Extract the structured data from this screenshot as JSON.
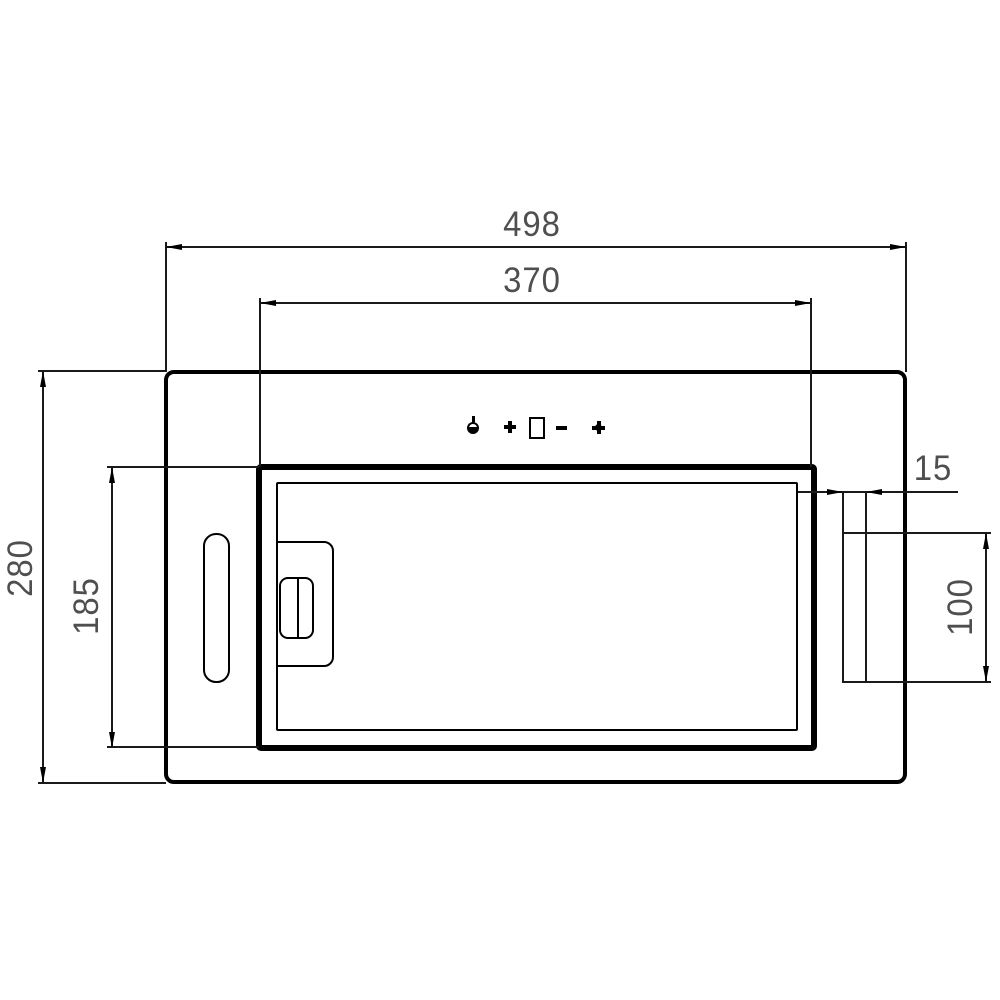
{
  "drawing": {
    "kind": "built-in cooker hood dimension drawing",
    "units": "mm",
    "dimensions": {
      "overall_width": "498",
      "inner_panel_width": "370",
      "overall_height": "280",
      "inner_panel_height": "185",
      "duct_flange_offset": "15",
      "duct_height": "100"
    },
    "control_icons": [
      "lamp",
      "plus",
      "display",
      "minus",
      "fan"
    ],
    "colors": {
      "line": "#000000",
      "dimension_text": "#4f4f4f",
      "background": "#ffffff"
    }
  }
}
